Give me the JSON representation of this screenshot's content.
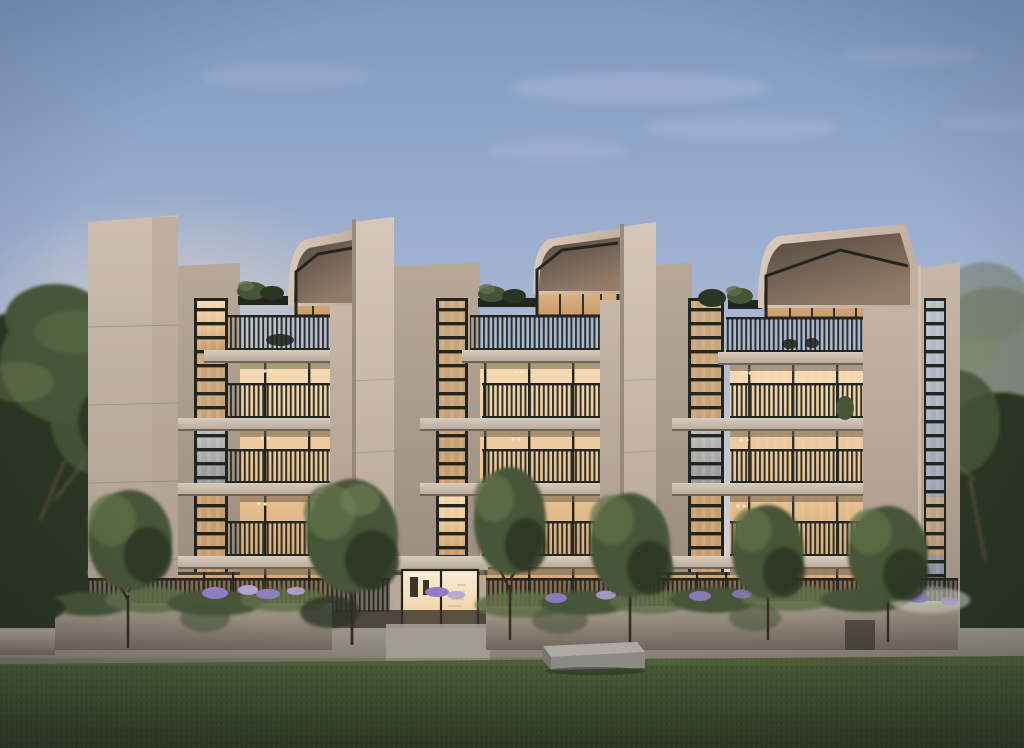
{
  "scene": {
    "subject": "Dusk architectural rendering of a five-storey apartment building with four concrete piers, three angled roof-hood penthouse bays, warm lit interiors, slatted balcony balustrades, landscaped planters with agapanthus, street trees and a foreground lawn",
    "time_of_day": "dusk",
    "floors_visible": 5,
    "hooded_bays": 3,
    "concrete_piers": 4,
    "front_trees": 6,
    "text_content": "none"
  },
  "palette": {
    "sky_top": "#7e98c2",
    "sky_mid": "#9fb1d0",
    "sky_lower": "#c9ccd9",
    "sky_horizon": "#ead9d2",
    "cloud": "#f5f0f1",
    "glow": "#f6ddc2",
    "facade_light": "#cdbeb0",
    "facade_shadow": "#a8998c",
    "pier_light": "#d6c7b8",
    "pier_shadow": "#b2a295",
    "pier2_light": "#c7b7a8",
    "pier2_shadow": "#a59687",
    "shoulder_light": "#b7a897",
    "shoulder_dark": "#97897b",
    "canopy_light": "#ddccbd",
    "canopy_dark": "#c0af9f",
    "soffit_dark": "#433b31",
    "soffit_warm": "#8e7562",
    "slab_light": "#d7cbbe",
    "slab_dark": "#b4a797",
    "slab_shadow": "#6e6356",
    "frame_dark": "#23261e",
    "glass_hi": "#f4dab4",
    "glass_warm": "#e8c190",
    "glass_amber": "#c89a6a",
    "glass_dim": "#caa87f",
    "glass_cool_hi": "#b9c1cb",
    "glass_cool": "#8b93a3",
    "lobby_hi": "#f9edd6",
    "lobby_warm": "#eccb92",
    "wall_light": "#a99e90",
    "wall_dark": "#6f675c",
    "path_light": "#9d968c",
    "path_dark": "#7f7970",
    "lawn_light": "#4c5c38",
    "lawn_dark": "#2e3a23",
    "fence_dark": "#3d372d",
    "foliage_dark": "#2b3524",
    "foliage_mid": "#465437",
    "foliage_light": "#5f6f48",
    "foliage_tip": "#7c8a5e",
    "foliage_haze": "#757f6d",
    "trunk": "#352c22",
    "branch": "#6b5b49",
    "flower_purple": "#8f7ec0",
    "flower_light": "#b3a4d6",
    "plume": "#cfd2bd",
    "bench_top": "#adaaa4",
    "bench_front": "#8c8a84",
    "shadow_ground": "#352f27",
    "downlight": "#ffe3b0"
  }
}
